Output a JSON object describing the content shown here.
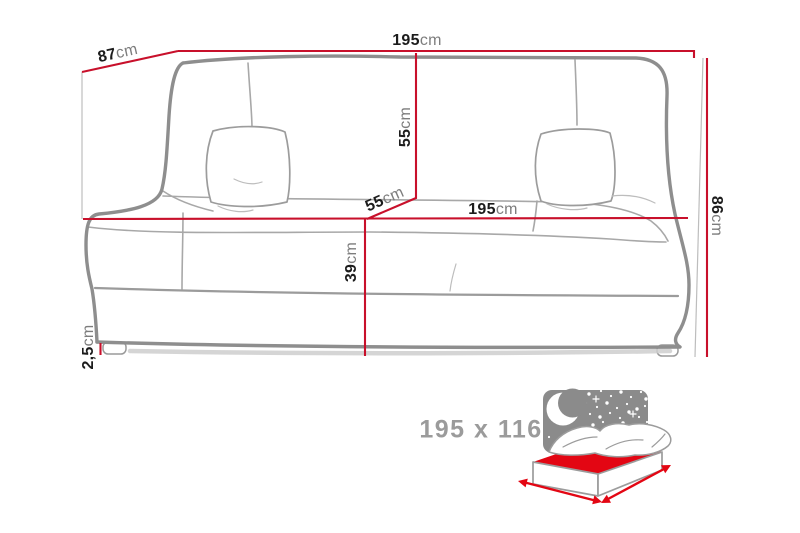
{
  "colors": {
    "background": "#ffffff",
    "dimension_red": "#c8102b",
    "sofa_outline_gray": "#8e8e8e",
    "value_text": "#1c1c1c",
    "unit_text": "#7d7d7d",
    "icon_sky_gray": "#8b8b8b",
    "bed_red": "#e30613",
    "bed_size_text": "#9b9b9b"
  },
  "diagram": {
    "dimensions": {
      "top_width": {
        "value": "195",
        "unit": "cm"
      },
      "depth": {
        "value": "87",
        "unit": "cm"
      },
      "backrest_height": {
        "value": "55",
        "unit": "cm"
      },
      "seat_depth": {
        "value": "55",
        "unit": "cm"
      },
      "seat_width": {
        "value": "195",
        "unit": "cm"
      },
      "overall_height": {
        "value": "86",
        "unit": "cm"
      },
      "seat_height": {
        "value": "39",
        "unit": "cm"
      },
      "leg_height": {
        "value": "2,5",
        "unit": "cm"
      }
    },
    "sleeping_area": {
      "label": "195 x 116",
      "icons": [
        "night-sky-panel",
        "crescent-moon-icon",
        "starfield",
        "sofa-bed-mattress-icon",
        "width-arrow",
        "depth-arrow"
      ]
    }
  }
}
